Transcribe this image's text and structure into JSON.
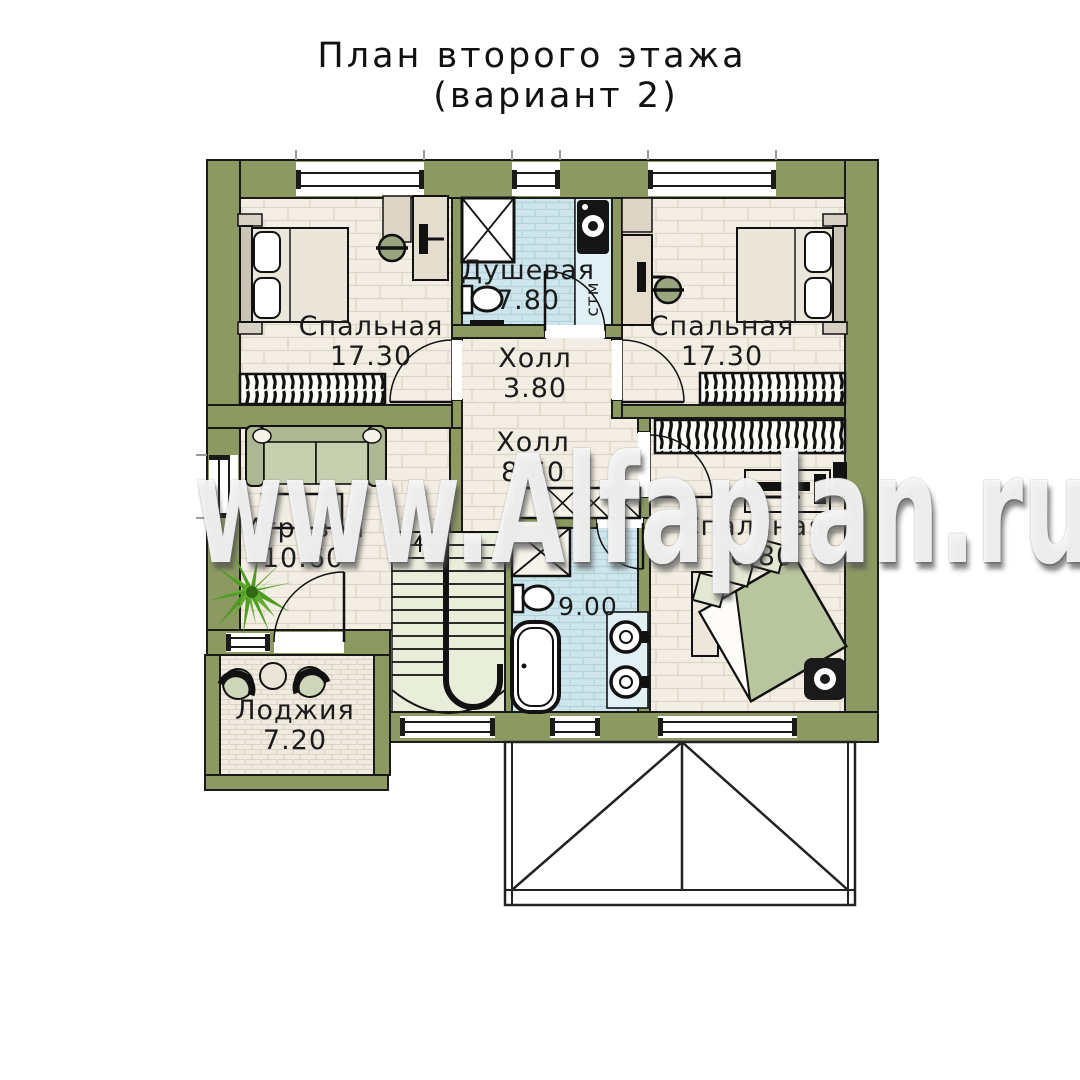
{
  "title": {
    "line1": "План второго этажа",
    "line2": "(вариант 2)"
  },
  "watermark": {
    "text": "www.Alfaplan.ru"
  },
  "rooms": {
    "bedroom_left": {
      "name": "Спальная",
      "area": "17.30"
    },
    "shower": {
      "name": "Душевая",
      "area": "7.80"
    },
    "bedroom_right": {
      "name": "Спальная",
      "area": "17.30"
    },
    "hall_upper": {
      "name": "Холл",
      "area": "3.80"
    },
    "hall_main": {
      "name": "Холл",
      "area": "8.60"
    },
    "playroom": {
      "name": "Игровая",
      "area": "10.60"
    },
    "bedroom_master": {
      "name": "Спальная",
      "area": "20.80"
    },
    "bathroom": {
      "area": "9.00"
    },
    "loggia": {
      "name": "Лоджия",
      "area": "7.20"
    }
  },
  "annotations": {
    "washing_machine": "стм"
  },
  "colors": {
    "wall_olive": "#8c9a62",
    "outline": "#1a1a1a",
    "floor_plank": "#f3eee4",
    "tile_blue": "#cde5eb",
    "tile_blue_light": "#e0f0f4",
    "stairs_green": "#e9eeda",
    "loggia_tile": "#f0ebe0",
    "cushion_green": "#b9c59e",
    "plant_green": "#4f9c22"
  }
}
